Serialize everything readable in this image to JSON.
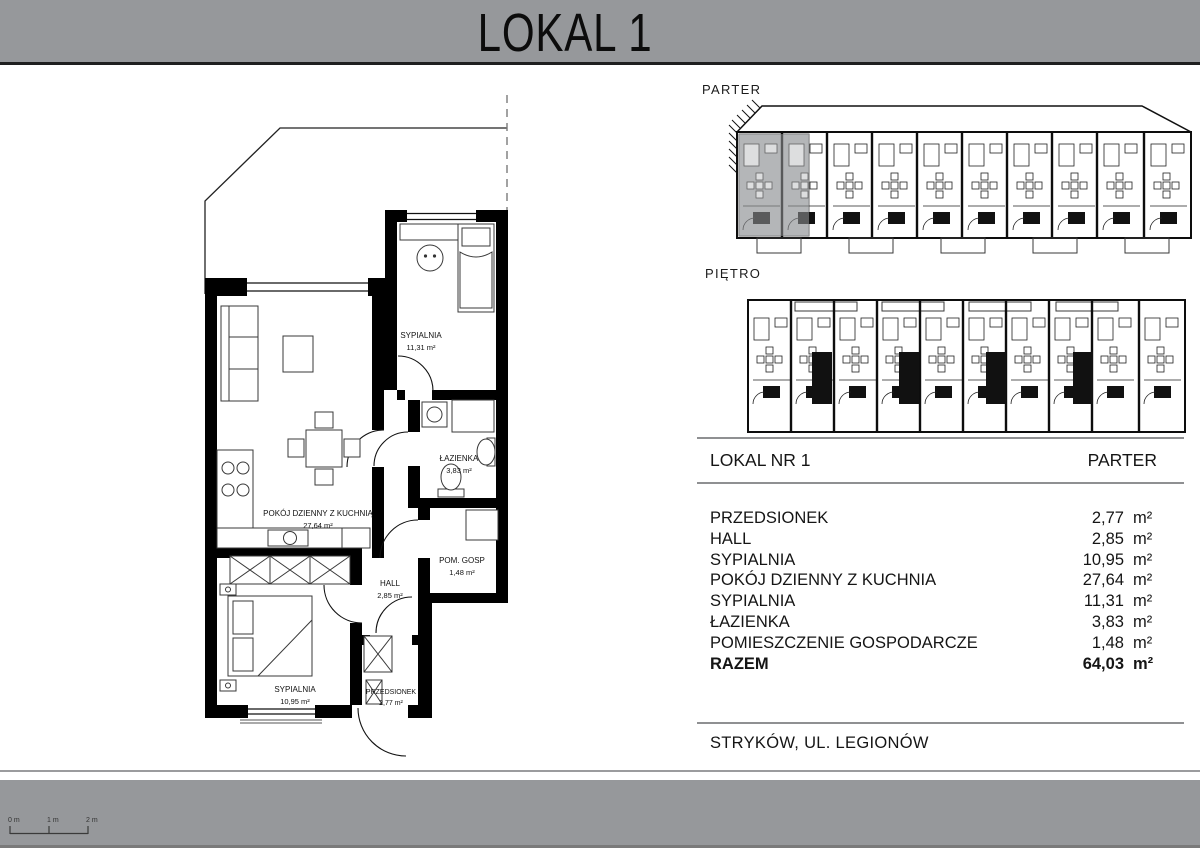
{
  "header": {
    "title": "LOKAL 1"
  },
  "overview": {
    "parter_label": "PARTER",
    "pietro_label": "PIĘTRO"
  },
  "floor_plan": {
    "rooms": [
      {
        "name": "SYPIALNIA",
        "area": "11,31 m²"
      },
      {
        "name": "POKÓJ DZIENNY Z KUCHNIĄ",
        "area": "27,64 m²"
      },
      {
        "name": "ŁAZIENKA",
        "area": "3,83 m²"
      },
      {
        "name": "POM. GOSP",
        "area": "1,48 m²"
      },
      {
        "name": "HALL",
        "area": "2,85 m²"
      },
      {
        "name": "SYPIALNIA",
        "area": "10,95 m²"
      },
      {
        "name": "PRZEDSIONEK",
        "area": "2,77 m²"
      }
    ]
  },
  "unit_table": {
    "name": "LOKAL NR 1",
    "floor": "PARTER",
    "rows": [
      {
        "room": "PRZEDSIONEK",
        "area": "2,77",
        "unit": "m²"
      },
      {
        "room": "HALL",
        "area": "2,85",
        "unit": "m²"
      },
      {
        "room": "SYPIALNIA",
        "area": "10,95",
        "unit": "m²"
      },
      {
        "room": "POKÓJ DZIENNY Z KUCHNIA",
        "area": "27,64",
        "unit": "m²"
      },
      {
        "room": "SYPIALNIA",
        "area": "11,31",
        "unit": "m²"
      },
      {
        "room": "ŁAZIENKA",
        "area": "3,83",
        "unit": "m²"
      },
      {
        "room": "POMIESZCZENIE GOSPODARCZE",
        "area": "1,48",
        "unit": "m²"
      }
    ],
    "total": {
      "room": "RAZEM",
      "area": "64,03",
      "unit": "m²"
    }
  },
  "address": "STRYKÓW, UL. LEGIONÓW",
  "scale_bar": {
    "labels": [
      "0 m",
      "1 m",
      "2 m"
    ]
  }
}
